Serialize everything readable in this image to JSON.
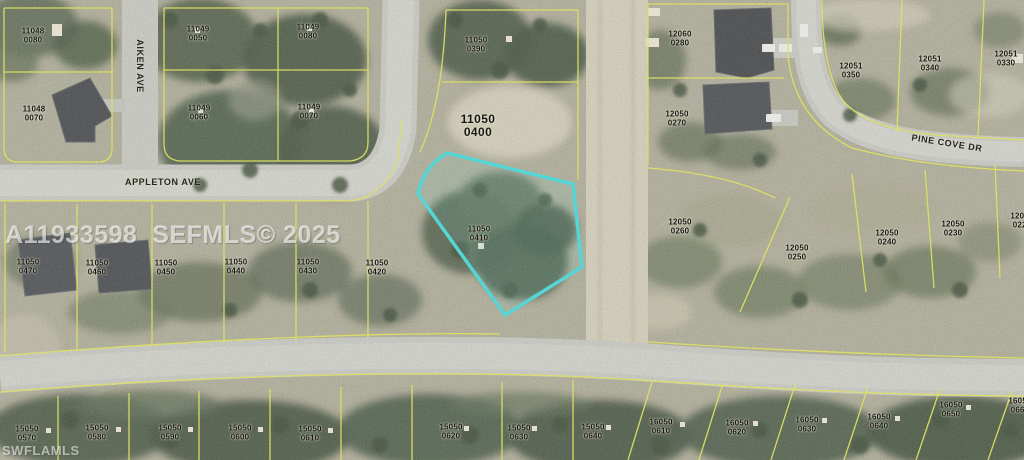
{
  "map": {
    "mls_watermark": "A11933598  SEFMLS© 2025",
    "brand_watermark": "SWFLAMLS",
    "highlighted_parcel": {
      "block": "11050",
      "lot": "0410"
    },
    "colors": {
      "highlight": "#3BDCDC",
      "parcel_line": "#E6EA4D",
      "road": "#C9C9C2",
      "label_text": "#16160F",
      "watermark": "#FFFFFF"
    },
    "streets": [
      {
        "name": "AIKEN AVE",
        "x": 140,
        "y": 66,
        "rotation": 90
      },
      {
        "name": "APPLETON AVE",
        "x": 163,
        "y": 182,
        "rotation": 0
      },
      {
        "name": "PINE COVE DR",
        "x": 947,
        "y": 143,
        "rotation": 9
      }
    ],
    "parcels": [
      {
        "block": "11048",
        "lot": "0080",
        "x": 33,
        "y": 36
      },
      {
        "block": "11048",
        "lot": "0070",
        "x": 34,
        "y": 114
      },
      {
        "block": "11049",
        "lot": "0050",
        "x": 198,
        "y": 34
      },
      {
        "block": "11049",
        "lot": "0080",
        "x": 308,
        "y": 32
      },
      {
        "block": "11049",
        "lot": "0060",
        "x": 199,
        "y": 113
      },
      {
        "block": "11049",
        "lot": "0070",
        "x": 309,
        "y": 112
      },
      {
        "block": "11050",
        "lot": "0390",
        "x": 476,
        "y": 45
      },
      {
        "block": "11050",
        "lot": "0400",
        "x": 478,
        "y": 126,
        "large": true
      },
      {
        "block": "11050",
        "lot": "0410",
        "x": 479,
        "y": 234,
        "highlight": true
      },
      {
        "block": "11050",
        "lot": "0470",
        "x": 28,
        "y": 267
      },
      {
        "block": "11050",
        "lot": "0460",
        "x": 97,
        "y": 268
      },
      {
        "block": "11050",
        "lot": "0450",
        "x": 166,
        "y": 268
      },
      {
        "block": "11050",
        "lot": "0440",
        "x": 236,
        "y": 267
      },
      {
        "block": "11050",
        "lot": "0430",
        "x": 308,
        "y": 267
      },
      {
        "block": "11050",
        "lot": "0420",
        "x": 377,
        "y": 268
      },
      {
        "block": "12060",
        "lot": "0280",
        "x": 680,
        "y": 39
      },
      {
        "block": "12050",
        "lot": "0270",
        "x": 677,
        "y": 119
      },
      {
        "block": "12051",
        "lot": "0350",
        "x": 851,
        "y": 71
      },
      {
        "block": "12051",
        "lot": "0340",
        "x": 930,
        "y": 64
      },
      {
        "block": "12051",
        "lot": "0330",
        "x": 1006,
        "y": 59
      },
      {
        "block": "12050",
        "lot": "0260",
        "x": 680,
        "y": 227
      },
      {
        "block": "12050",
        "lot": "0250",
        "x": 797,
        "y": 253
      },
      {
        "block": "12050",
        "lot": "0240",
        "x": 887,
        "y": 238
      },
      {
        "block": "12050",
        "lot": "0230",
        "x": 953,
        "y": 229
      },
      {
        "block": "12050",
        "lot": "0220",
        "x": 1022,
        "y": 221
      },
      {
        "block": "15050",
        "lot": "0570",
        "x": 27,
        "y": 434
      },
      {
        "block": "15050",
        "lot": "0580",
        "x": 97,
        "y": 433
      },
      {
        "block": "15050",
        "lot": "0590",
        "x": 170,
        "y": 433
      },
      {
        "block": "15050",
        "lot": "0600",
        "x": 240,
        "y": 433
      },
      {
        "block": "15050",
        "lot": "0610",
        "x": 310,
        "y": 434
      },
      {
        "block": "15050",
        "lot": "0620",
        "x": 451,
        "y": 432
      },
      {
        "block": "15050",
        "lot": "0630",
        "x": 519,
        "y": 433
      },
      {
        "block": "15050",
        "lot": "0640",
        "x": 593,
        "y": 432
      },
      {
        "block": "16050",
        "lot": "0610",
        "x": 661,
        "y": 427
      },
      {
        "block": "16050",
        "lot": "0620",
        "x": 737,
        "y": 428
      },
      {
        "block": "16050",
        "lot": "0630",
        "x": 807,
        "y": 425
      },
      {
        "block": "16050",
        "lot": "0640",
        "x": 879,
        "y": 422
      },
      {
        "block": "16050",
        "lot": "0650",
        "x": 951,
        "y": 410
      },
      {
        "block": "16050",
        "lot": "0660",
        "x": 1020,
        "y": 406
      }
    ]
  }
}
